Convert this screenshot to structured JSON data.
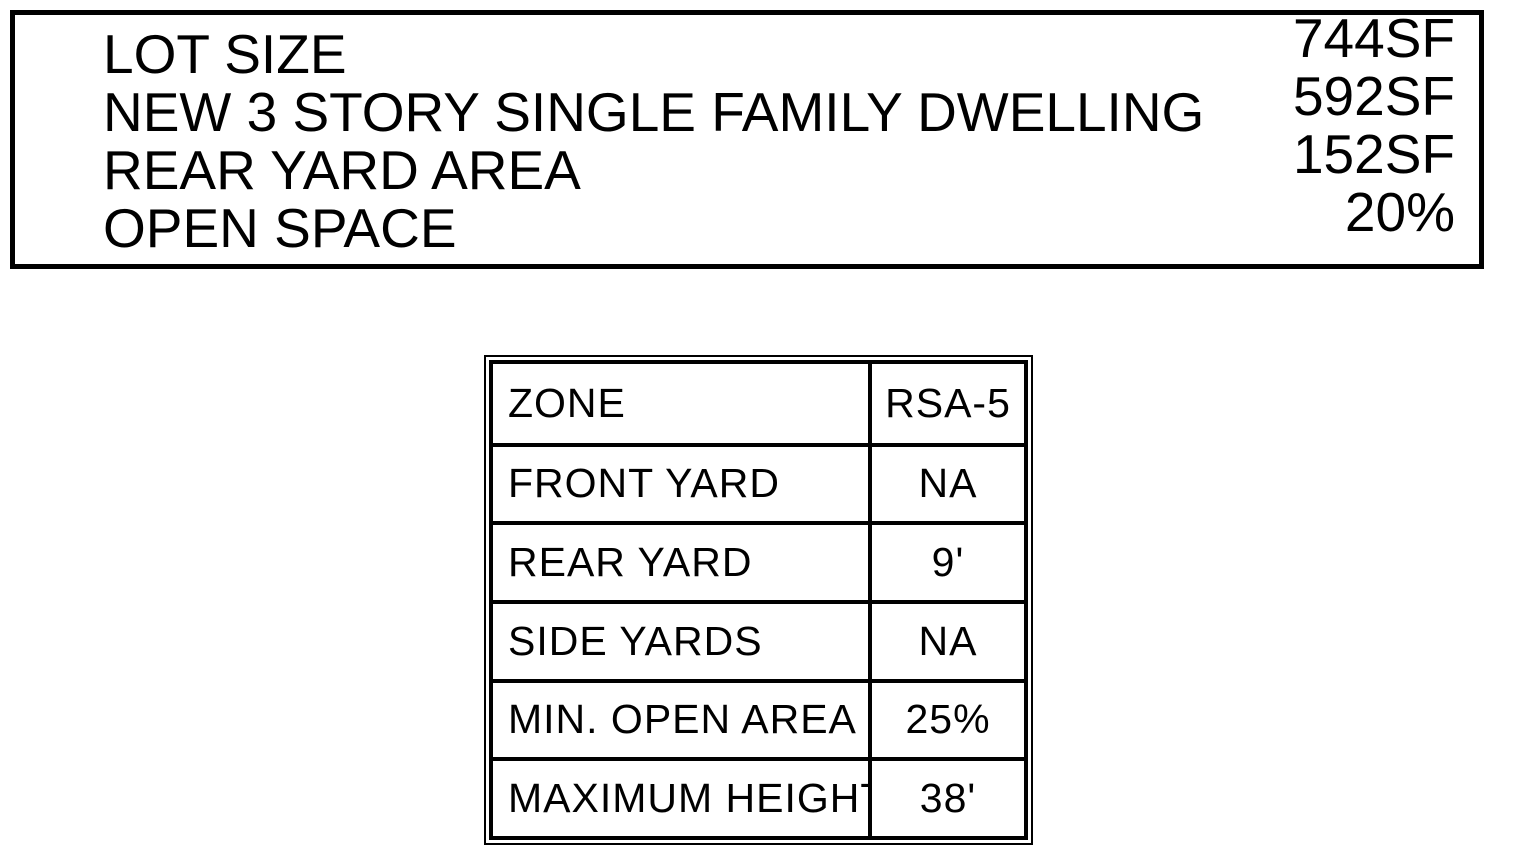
{
  "page": {
    "background_color": "#ffffff",
    "ink_color": "#000000"
  },
  "project_summary": {
    "rows": [
      {
        "label": "LOT SIZE",
        "value": "744SF"
      },
      {
        "label": "NEW 3 STORY SINGLE FAMILY DWELLING",
        "value": "592SF"
      },
      {
        "label": "REAR YARD AREA",
        "value": "152SF"
      },
      {
        "label": "OPEN SPACE",
        "value": "20%"
      }
    ]
  },
  "zoning_table": {
    "rows": [
      {
        "label": "ZONE",
        "value": "RSA-5"
      },
      {
        "label": "FRONT YARD",
        "value": "NA"
      },
      {
        "label": "REAR YARD",
        "value": "9'"
      },
      {
        "label": "SIDE YARDS",
        "value": "NA"
      },
      {
        "label": "MIN. OPEN AREA",
        "value": "25%"
      },
      {
        "label": "MAXIMUM HEIGHT",
        "value": "38'"
      }
    ]
  }
}
